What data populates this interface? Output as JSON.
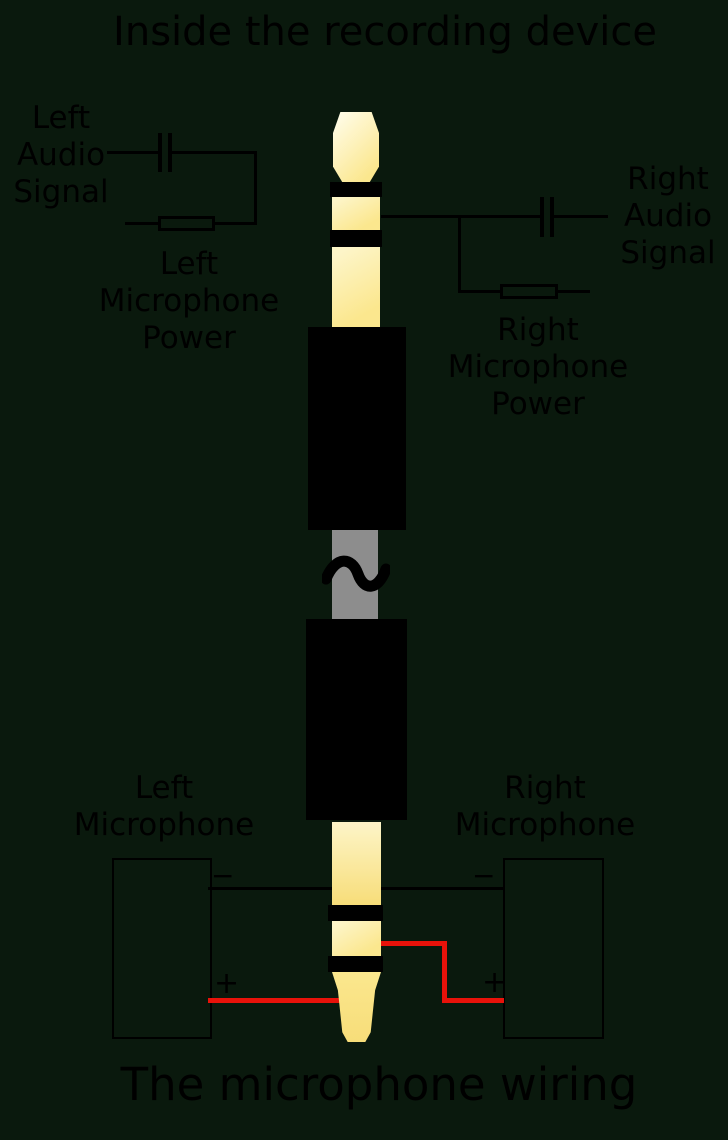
{
  "colors": {
    "background": "#0a190d",
    "line": "#000000",
    "red": "#e8120a",
    "gray": "#8d8d8d",
    "gold_light": "#fdf5c8",
    "gold": "#fbe78e",
    "gold_deep": "#f7dd79",
    "sleeve": "#000000"
  },
  "titles": {
    "top": "Inside the recording device",
    "bottom": "The microphone wiring"
  },
  "top_section": {
    "left_audio_signal": "Left\nAudio\nSignal",
    "right_audio_signal": "Right\nAudio\nSignal",
    "left_mic_power": "Left\nMicrophone\nPower",
    "right_mic_power": "Right\nMicrophone\nPower"
  },
  "bottom_section": {
    "left_microphone": "Left\nMicrophone",
    "right_microphone": "Right\nMicrophone",
    "left_minus": "−",
    "left_plus": "+",
    "right_minus": "−",
    "right_plus": "+"
  },
  "icons": {
    "capacitor_left": "capacitor-symbol",
    "capacitor_right": "capacitor-symbol",
    "resistor_left": "resistor-symbol",
    "resistor_right": "resistor-symbol",
    "break_squiggle": "wave-break-symbol"
  }
}
